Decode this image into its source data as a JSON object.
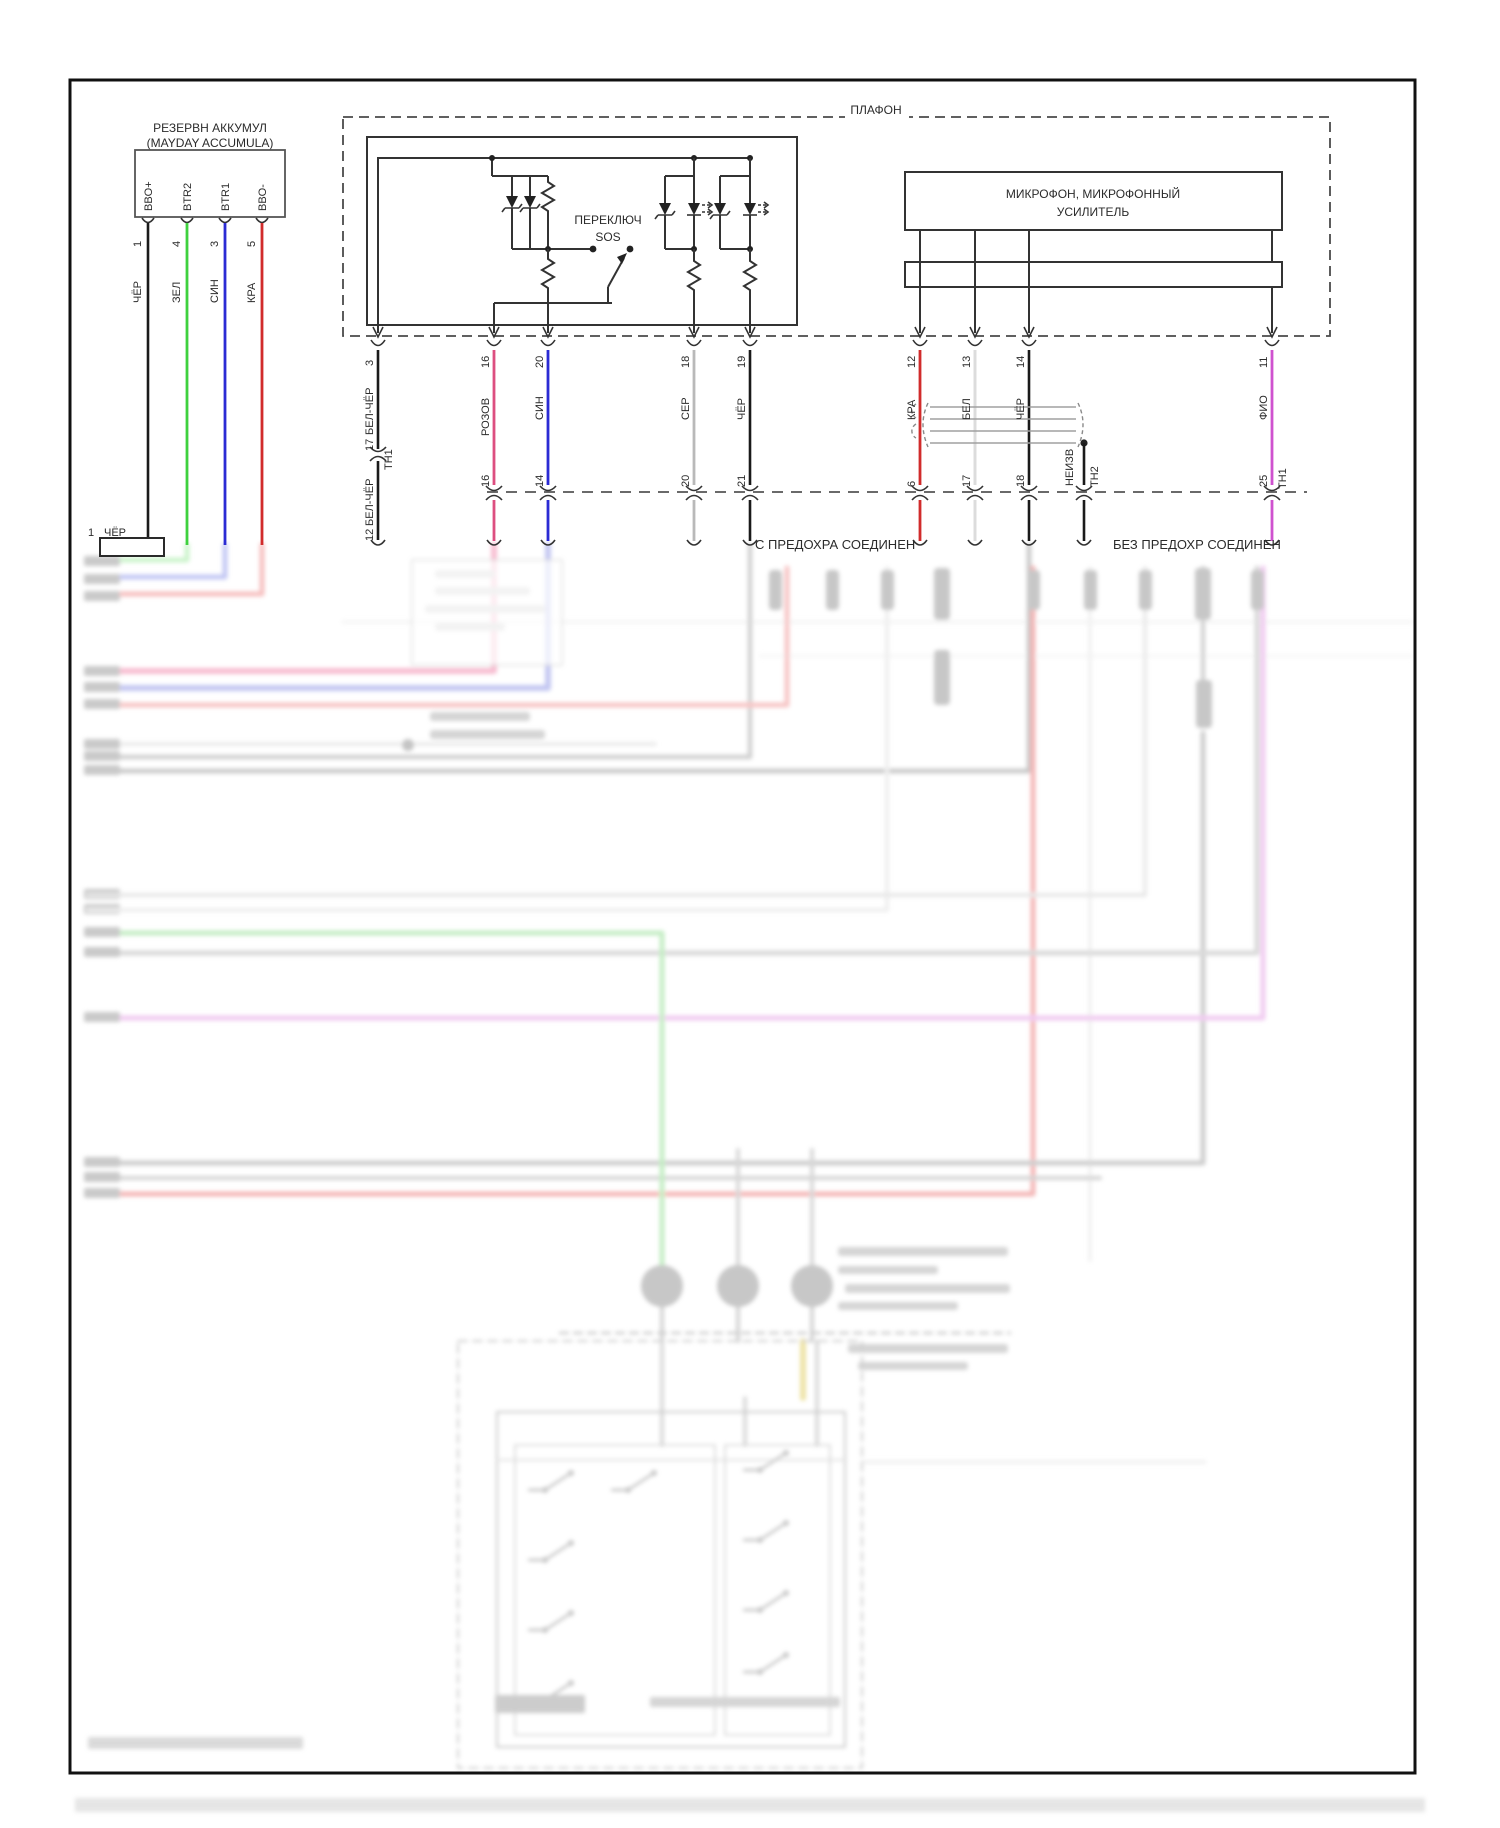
{
  "battery": {
    "title1": "РЕЗЕРВН АККУМУЛ",
    "title2": "(MAYDAY ACCUMULA)",
    "pins": [
      {
        "terminal": "BBO+",
        "pin": "1",
        "wire": "ЧЁР"
      },
      {
        "terminal": "BTR2",
        "pin": "4",
        "wire": "ЗЕЛ"
      },
      {
        "terminal": "BTR1",
        "pin": "3",
        "wire": "СИН"
      },
      {
        "terminal": "BBO-",
        "pin": "5",
        "wire": "КРА"
      }
    ]
  },
  "plafon": {
    "label": "ПЛАФОН",
    "switch_line1": "ПЕРЕКЛЮЧ",
    "switch_line2": "SOS"
  },
  "microphone": {
    "line1": "МИКРОФОН, МИКРОФОННЫЙ",
    "line2": "УСИЛИТЕЛЬ"
  },
  "harness": {
    "wires": [
      {
        "color": "БЕЛ-ЧЁР",
        "pin_top": "3",
        "pin_mid": "17",
        "mid_connector": "ТН1",
        "pin_bottom": "12"
      },
      {
        "color": "РОЗОВ",
        "pin_top": "16",
        "pin_bottom": "16"
      },
      {
        "color": "СИН",
        "pin_top": "20",
        "pin_bottom": "14"
      },
      {
        "color": "СЕР",
        "pin_top": "18",
        "pin_bottom": "20"
      },
      {
        "color": "ЧЁР",
        "pin_top": "19",
        "pin_bottom": "21"
      },
      {
        "color": "КРА",
        "pin_top": "12",
        "pin_bottom": "6"
      },
      {
        "color": "БЕЛ",
        "pin_top": "13",
        "pin_bottom": "17"
      },
      {
        "color": "ЧЁР",
        "pin_top": "14",
        "pin_bottom": "18"
      },
      {
        "color": "НЕИЗВ",
        "bottom_connector": "ТН2"
      },
      {
        "color": "ФИО",
        "pin_top": "11",
        "pin_bottom": "25",
        "bottom_connector": "ТН1"
      }
    ]
  },
  "junctions": {
    "with_fuse": "С ПРЕДОХРА СОЕДИНЕН",
    "without_fuse": "БЕЗ ПРЕДОХР СОЕДИНЕН"
  },
  "ground": {
    "pin": "1",
    "wire": "ЧЁР"
  },
  "colors": {
    "wire_black": "#1a1a1a",
    "wire_green": "#3ed13e",
    "wire_blue": "#2b2bd4",
    "wire_red": "#d12b2b",
    "wire_pink": "#dd4f80",
    "wire_gray": "#b9b9b9",
    "wire_white": "#dcdcdc",
    "wire_violet": "#cf52cf",
    "diagram_line": "#333333"
  }
}
